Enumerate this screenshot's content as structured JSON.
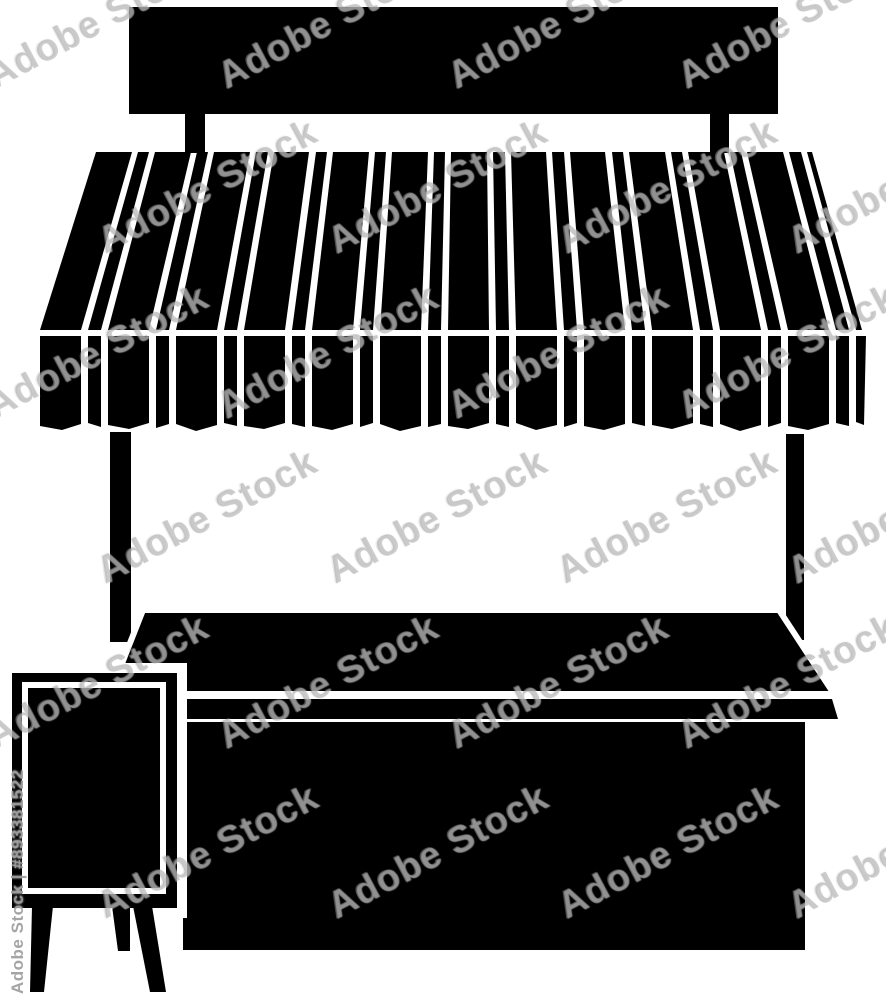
{
  "artwork": {
    "description": "Black and white silhouette illustration of a market stall with a striped awning, blank signboard, counter and a chalkboard easel sign",
    "background_color": "#ffffff",
    "silhouette_color": "#000000"
  },
  "watermark": {
    "tile_text": "Adobe Stock",
    "id_text": "Adobe Stock | #893381522",
    "tile_color": "#969696",
    "id_color": "#9b9b9b"
  }
}
